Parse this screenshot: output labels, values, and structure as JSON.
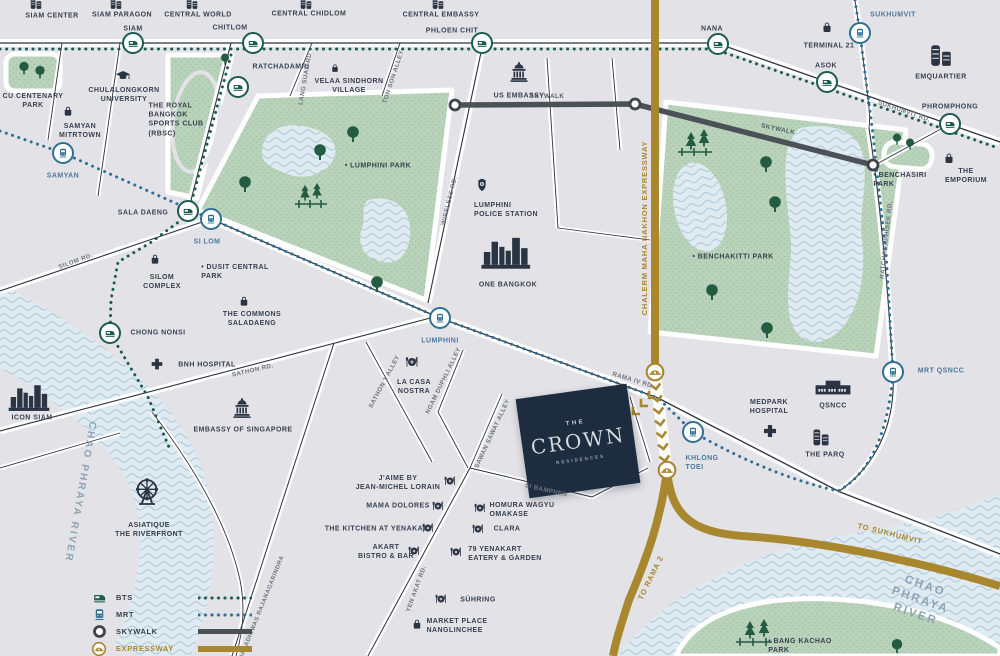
{
  "map": {
    "title": "The Crown Residences location map",
    "colors": {
      "bts": "#1c5b50",
      "mrt": "#2f7092",
      "skywalk": "#4b5157",
      "expressway": "#a8872e",
      "park": "#b9d2ba",
      "water": "#dfeaf1",
      "crown_navy": "#1d2d3f",
      "label_navy": "#39414e"
    },
    "crown": {
      "top": "THE",
      "name": "CROWN",
      "sub": "RESIDENCES"
    },
    "legend": {
      "items": [
        {
          "label": "BTS",
          "type": "bts"
        },
        {
          "label": "MRT",
          "type": "mrt"
        },
        {
          "label": "SKYWALK",
          "type": "skywalk"
        },
        {
          "label": "EXPRESSWAY",
          "type": "expressway"
        },
        {
          "label": "ROAD",
          "type": "road"
        }
      ]
    },
    "stations": [
      {
        "name": "station-siam",
        "type": "bts",
        "x": 133,
        "y": 43
      },
      {
        "name": "station-chitlom",
        "type": "bts",
        "x": 253,
        "y": 43
      },
      {
        "name": "station-phloen-chit",
        "type": "bts",
        "x": 482,
        "y": 43
      },
      {
        "name": "station-nana",
        "type": "bts",
        "x": 718,
        "y": 44
      },
      {
        "name": "station-asok",
        "type": "bts",
        "x": 827,
        "y": 82
      },
      {
        "name": "station-phromphong",
        "type": "bts",
        "x": 950,
        "y": 124
      },
      {
        "name": "station-ratchadamri",
        "type": "bts",
        "x": 238,
        "y": 87
      },
      {
        "name": "station-sala-daeng",
        "type": "bts",
        "x": 188,
        "y": 211
      },
      {
        "name": "station-chong-nonsi",
        "type": "bts",
        "x": 110,
        "y": 333
      },
      {
        "name": "station-sukhumvit",
        "type": "mrt",
        "x": 860,
        "y": 33
      },
      {
        "name": "station-samyan",
        "type": "mrt",
        "x": 63,
        "y": 153
      },
      {
        "name": "station-si-lom",
        "type": "mrt",
        "x": 211,
        "y": 219
      },
      {
        "name": "station-lumphini",
        "type": "mrt",
        "x": 440,
        "y": 318
      },
      {
        "name": "station-khlong-toei",
        "type": "mrt",
        "x": 693,
        "y": 432
      },
      {
        "name": "station-qsncc",
        "type": "mrt",
        "x": 893,
        "y": 372
      }
    ],
    "icons": [
      {
        "name": "siam-center-icon",
        "type": "towers",
        "x": 36,
        "y": 3,
        "s": 14
      },
      {
        "name": "siam-paragon-icon",
        "type": "towers",
        "x": 116,
        "y": 3,
        "s": 14
      },
      {
        "name": "central-world-icon",
        "type": "towers",
        "x": 192,
        "y": 3,
        "s": 14
      },
      {
        "name": "central-chidlom-icon",
        "type": "towers",
        "x": 306,
        "y": 3,
        "s": 14
      },
      {
        "name": "central-embassy-icon",
        "type": "towers",
        "x": 438,
        "y": 3,
        "s": 14
      },
      {
        "name": "terminal-21-icon",
        "type": "bag",
        "x": 827,
        "y": 27,
        "s": 14
      },
      {
        "name": "emquartier-icon",
        "type": "towers",
        "x": 941,
        "y": 55,
        "s": 26
      },
      {
        "name": "the-emporium-icon",
        "type": "bag",
        "x": 949,
        "y": 158,
        "s": 14
      },
      {
        "name": "velaa-sindhorn-icon",
        "type": "bag",
        "x": 335,
        "y": 68,
        "s": 11
      },
      {
        "name": "samyan-mitrtown-icon",
        "type": "bag",
        "x": 68,
        "y": 111,
        "s": 13
      },
      {
        "name": "silom-complex-icon",
        "type": "bag",
        "x": 155,
        "y": 259,
        "s": 13
      },
      {
        "name": "the-commons-icon",
        "type": "bag",
        "x": 244,
        "y": 301,
        "s": 13
      },
      {
        "name": "market-place-icon",
        "type": "bag",
        "x": 417,
        "y": 624,
        "s": 13
      },
      {
        "name": "us-embassy-icon",
        "type": "capitol",
        "x": 519,
        "y": 72,
        "s": 24
      },
      {
        "name": "embassy-singapore-icon",
        "type": "capitol",
        "x": 242,
        "y": 408,
        "s": 24
      },
      {
        "name": "chulalongkorn-icon",
        "type": "gradcap",
        "x": 123,
        "y": 76,
        "s": 17
      },
      {
        "name": "police-badge-icon",
        "type": "badge",
        "x": 482,
        "y": 185,
        "s": 16
      },
      {
        "name": "one-bangkok-icon",
        "type": "skyline",
        "x": 507,
        "y": 252,
        "w": 52,
        "h": 36
      },
      {
        "name": "icon-siam-icon",
        "type": "skyline",
        "x": 30,
        "y": 397,
        "w": 44,
        "h": 30
      },
      {
        "name": "qsncc-icon",
        "type": "hall",
        "x": 833,
        "y": 388,
        "w": 38,
        "h": 22
      },
      {
        "name": "the-parq-icon",
        "type": "towers",
        "x": 821,
        "y": 437,
        "s": 20
      },
      {
        "name": "bnh-cross-icon",
        "type": "cross",
        "x": 157,
        "y": 364,
        "s": 15
      },
      {
        "name": "medpark-cross-icon",
        "type": "cross",
        "x": 770,
        "y": 431,
        "s": 17
      },
      {
        "name": "asiatique-ferris-icon",
        "type": "ferris",
        "x": 147,
        "y": 492,
        "s": 32
      },
      {
        "name": "la-casa-nostra-icon",
        "type": "dining",
        "x": 412,
        "y": 362,
        "s": 16
      },
      {
        "name": "jaime-icon",
        "type": "dining",
        "x": 450,
        "y": 481,
        "s": 14
      },
      {
        "name": "mama-dolores-icon",
        "type": "dining",
        "x": 438,
        "y": 506,
        "s": 14
      },
      {
        "name": "kitchen-yenakat-icon",
        "type": "dining",
        "x": 428,
        "y": 528,
        "s": 14
      },
      {
        "name": "akart-icon",
        "type": "dining",
        "x": 414,
        "y": 551,
        "s": 14
      },
      {
        "name": "homura-icon",
        "type": "dining",
        "x": 480,
        "y": 508,
        "s": 14
      },
      {
        "name": "clara-icon",
        "type": "dining",
        "x": 478,
        "y": 529,
        "s": 14
      },
      {
        "name": "yenakart-79-icon",
        "type": "dining",
        "x": 456,
        "y": 552,
        "s": 14
      },
      {
        "name": "suhring-icon",
        "type": "dining",
        "x": 441,
        "y": 599,
        "s": 14
      },
      {
        "name": "interchange-icon",
        "type": "interchange",
        "x": 655,
        "y": 372,
        "s": 21
      },
      {
        "name": "interchange-icon",
        "type": "interchange",
        "x": 667,
        "y": 470,
        "s": 21
      },
      {
        "name": "skywalk-node-icon",
        "type": "ring",
        "x": 455,
        "y": 105,
        "s": 15
      },
      {
        "name": "skywalk-node-icon",
        "type": "ring",
        "x": 635,
        "y": 104,
        "s": 15
      },
      {
        "name": "skywalk-node-icon",
        "type": "ring",
        "x": 873,
        "y": 165,
        "s": 15
      }
    ],
    "labels": [
      {
        "name": "label-siam-center",
        "text": "SIAM CENTER",
        "x": 52,
        "y": 16
      },
      {
        "name": "label-siam-paragon",
        "text": "SIAM PARAGON",
        "x": 122,
        "y": 15
      },
      {
        "name": "label-central-world",
        "text": "CENTRAL WORLD",
        "x": 198,
        "y": 15
      },
      {
        "name": "label-central-chidlom",
        "text": "CENTRAL CHIDLOM",
        "x": 309,
        "y": 14
      },
      {
        "name": "label-central-embassy",
        "text": "CENTRAL EMBASSY",
        "x": 441,
        "y": 15
      },
      {
        "name": "label-st-siam",
        "text": "SIAM",
        "x": 133,
        "y": 29,
        "cls": "bts"
      },
      {
        "name": "label-st-chitlom",
        "text": "CHITLOM",
        "x": 230,
        "y": 28,
        "cls": "bts"
      },
      {
        "name": "label-st-phloen-chit",
        "text": "PHLOEN CHIT",
        "x": 452,
        "y": 31,
        "cls": "bts"
      },
      {
        "name": "label-st-ratchadamri",
        "text": "RATCHADAMRI",
        "x": 281,
        "y": 67,
        "cls": "bts"
      },
      {
        "name": "label-st-nana",
        "text": "NANA",
        "x": 712,
        "y": 29,
        "cls": "bts"
      },
      {
        "name": "label-st-asok",
        "text": "ASOK",
        "x": 826,
        "y": 66,
        "cls": "bts"
      },
      {
        "name": "label-st-phromphong",
        "text": "PHROMPHONG",
        "x": 950,
        "y": 107,
        "cls": "bts"
      },
      {
        "name": "label-st-sukhumvit",
        "text": "SUKHUMVIT",
        "x": 893,
        "y": 15,
        "cls": "mrt"
      },
      {
        "name": "label-terminal-21",
        "text": "TERMINAL 21",
        "x": 829,
        "y": 46
      },
      {
        "name": "label-emquartier",
        "text": "EMQUARTIER",
        "x": 941,
        "y": 77
      },
      {
        "name": "label-sukhumvit-rd",
        "text": "SUKHUMVIT RD.",
        "x": 904,
        "y": 112,
        "cls": "road",
        "rot": 19
      },
      {
        "name": "label-lang-suan-rd",
        "text": "LANG SUAN RD",
        "x": 306,
        "y": 79,
        "cls": "road",
        "rot": -80
      },
      {
        "name": "label-ton-son-alley",
        "text": "TON SON ALLEY",
        "x": 394,
        "y": 77,
        "cls": "road",
        "rot": -72
      },
      {
        "name": "label-velaa",
        "text": "VELAA SINDHORN\nVILLAGE",
        "x": 349,
        "y": 86
      },
      {
        "name": "label-cu-park",
        "text": "CU CENTENARY\nPARK",
        "x": 33,
        "y": 101
      },
      {
        "name": "label-chula",
        "text": "CHULALONGKORN\nUNIVERSITY",
        "x": 124,
        "y": 95
      },
      {
        "name": "label-samyan-mitrtown",
        "text": "SAMYAN\nMITRTOWN",
        "x": 80,
        "y": 131
      },
      {
        "name": "label-rbsc",
        "text": "THE ROYAL\nBANGKOK\nSPORTS CLUB\n(RBSC)",
        "x": 176,
        "y": 120,
        "align": "left"
      },
      {
        "name": "label-st-samyan",
        "text": "SAMYAN",
        "x": 63,
        "y": 176,
        "cls": "mrt"
      },
      {
        "name": "label-us-embassy",
        "text": "US EMBASSY",
        "x": 519,
        "y": 96
      },
      {
        "name": "label-skywalk-1",
        "text": "SKYWALK",
        "x": 547,
        "y": 97,
        "cls": "sky"
      },
      {
        "name": "label-skywalk-2",
        "text": "SKYWALK",
        "x": 778,
        "y": 130,
        "cls": "sky",
        "rot": 12
      },
      {
        "name": "label-lumphini-park",
        "text": "•  LUMPHINI PARK",
        "x": 378,
        "y": 166
      },
      {
        "name": "label-benchakitti-park",
        "text": "•  BENCHAKITTI PARK",
        "x": 733,
        "y": 257
      },
      {
        "name": "label-benchasiri-park",
        "text": "•  BENCHASIRI\n PARK",
        "x": 900,
        "y": 180,
        "align": "left"
      },
      {
        "name": "label-the-emporium",
        "text": "THE EMPORIUM",
        "x": 966,
        "y": 176
      },
      {
        "name": "label-ratchadaphisek-rd",
        "text": "RATCHADAPHISEK RD.",
        "x": 887,
        "y": 240,
        "cls": "road",
        "rot": -84
      },
      {
        "name": "label-mrt-qsncc",
        "text": "MRT QSNCC",
        "x": 941,
        "y": 371,
        "cls": "mrt"
      },
      {
        "name": "label-st-sala-daeng",
        "text": "SALA DAENG",
        "x": 143,
        "y": 213,
        "cls": "bts"
      },
      {
        "name": "label-st-si-lom",
        "text": "SI LOM",
        "x": 207,
        "y": 242,
        "cls": "mrt"
      },
      {
        "name": "label-silom-rd",
        "text": "SILOM RD.",
        "x": 76,
        "y": 262,
        "cls": "road",
        "rot": -20
      },
      {
        "name": "label-silom-complex",
        "text": "SILOM\nCOMPLEX",
        "x": 162,
        "y": 282
      },
      {
        "name": "label-dusit-central-park",
        "text": "•  DUSIT CENTRAL\n PARK",
        "x": 235,
        "y": 272,
        "align": "left"
      },
      {
        "name": "label-the-commons",
        "text": "THE COMMONS\nSALADAENG",
        "x": 252,
        "y": 319
      },
      {
        "name": "label-st-chong-nonsi",
        "text": "CHONG NONSI",
        "x": 158,
        "y": 333,
        "cls": "bts"
      },
      {
        "name": "label-bnh",
        "text": "BNH HOSPITAL",
        "x": 207,
        "y": 365
      },
      {
        "name": "label-sathon-rd",
        "text": "SATHON RD.",
        "x": 253,
        "y": 371,
        "cls": "road",
        "rot": -13
      },
      {
        "name": "label-police-station",
        "text": "LUMPHINI\nPOLICE STATION",
        "x": 506,
        "y": 210,
        "align": "left"
      },
      {
        "name": "label-one-bangkok",
        "text": "ONE BANGKOK",
        "x": 508,
        "y": 285
      },
      {
        "name": "label-wireless-rd",
        "text": "WIRELESS RD.",
        "x": 450,
        "y": 201,
        "cls": "road",
        "rot": -76
      },
      {
        "name": "label-expressway",
        "text": "CHALERM MAHA NAKHON   EXPRESSWAY",
        "x": 645,
        "y": 228,
        "cls": "gold",
        "rot": -90
      },
      {
        "name": "label-st-lumphini",
        "text": "LUMPHINI",
        "x": 440,
        "y": 341,
        "cls": "mrt"
      },
      {
        "name": "label-rama4-rd",
        "text": "RAMA IV RD.",
        "x": 633,
        "y": 381,
        "cls": "road",
        "rot": 17
      },
      {
        "name": "label-icon-siam",
        "text": "ICON SIAM",
        "x": 32,
        "y": 418
      },
      {
        "name": "label-embassy-singapore",
        "text": "EMBASSY OF SINGAPORE",
        "x": 243,
        "y": 430
      },
      {
        "name": "label-asiatique",
        "text": "ASIATIQUE\nTHE RIVERFRONT",
        "x": 149,
        "y": 530
      },
      {
        "name": "label-chao-phraya-left",
        "text": "CHAO PHRAYA RIVER",
        "x": 80,
        "y": 492,
        "cls": "river",
        "rot": 100
      },
      {
        "name": "label-sathon1-alley",
        "text": "SATHON 1 ALLEY",
        "x": 385,
        "y": 382,
        "cls": "road",
        "rot": -62
      },
      {
        "name": "label-ngam-duphli",
        "text": "NGAM DUPHLI ALLEY",
        "x": 444,
        "y": 381,
        "cls": "road",
        "rot": -64
      },
      {
        "name": "label-la-casa-nostra",
        "text": "LA CASA\nNOSTRA",
        "x": 414,
        "y": 387
      },
      {
        "name": "label-sawan-sawat",
        "text": "SAWAN SAWAT ALLEY",
        "x": 493,
        "y": 434,
        "cls": "road",
        "rot": -65
      },
      {
        "name": "label-si-bamphen",
        "text": "SI BAMPHEN",
        "x": 546,
        "y": 491,
        "cls": "road",
        "rot": 13
      },
      {
        "name": "label-jaime",
        "text": "J'AIME BY\nJEAN-MICHEL LORAIN",
        "x": 398,
        "y": 483
      },
      {
        "name": "label-mama-dolores",
        "text": "MAMA DOLORES",
        "x": 398,
        "y": 506
      },
      {
        "name": "label-kitchen-yenakat",
        "text": "THE KITCHEN AT YENAKAT",
        "x": 376,
        "y": 529
      },
      {
        "name": "label-akart",
        "text": "AKART\nBISTRO & BAR",
        "x": 386,
        "y": 552
      },
      {
        "name": "label-homura",
        "text": "HOMURA WAGYU\nOMAKASE",
        "x": 522,
        "y": 510,
        "align": "left"
      },
      {
        "name": "label-clara",
        "text": "CLARA",
        "x": 507,
        "y": 529,
        "align": "left"
      },
      {
        "name": "label-yenakart-79",
        "text": "79 YENAKART\nEATERY & GARDEN",
        "x": 505,
        "y": 554,
        "align": "left"
      },
      {
        "name": "label-suhring",
        "text": "SÜHRING",
        "x": 478,
        "y": 600,
        "align": "left"
      },
      {
        "name": "label-market-place",
        "text": "MARKET PLACE\nNANGLINCHEE",
        "x": 457,
        "y": 626,
        "align": "left"
      },
      {
        "name": "label-yen-akat-rd",
        "text": "YEN AKAT RD.",
        "x": 417,
        "y": 589,
        "cls": "road",
        "rot": -70
      },
      {
        "name": "label-naradhiwas",
        "text": "NARADHIWAS RAJANAGARINDRA",
        "x": 263,
        "y": 608,
        "cls": "road",
        "rot": -68,
        "size": 6
      },
      {
        "name": "label-medpark",
        "text": "MEDPARK\nHOSPITAL",
        "x": 769,
        "y": 407
      },
      {
        "name": "label-qsncc",
        "text": "QSNCC",
        "x": 833,
        "y": 406
      },
      {
        "name": "label-the-parq",
        "text": "THE PARQ",
        "x": 825,
        "y": 455
      },
      {
        "name": "label-st-khlong-toei",
        "text": "KHLONG\nTOEI",
        "x": 702,
        "y": 463,
        "cls": "mrt",
        "align": "left"
      },
      {
        "name": "label-to-sukhumvit",
        "text": "TO SUKHUMVIT",
        "x": 890,
        "y": 534,
        "cls": "gold",
        "rot": 14
      },
      {
        "name": "label-to-rama-2",
        "text": "TO RAMA 2",
        "x": 651,
        "y": 578,
        "cls": "gold",
        "rot": -64
      },
      {
        "name": "label-chao-phraya-right",
        "text": "CHAO PHRAYA RIVER",
        "x": 920,
        "y": 601,
        "cls": "river",
        "rot": 19,
        "size": 11.5
      },
      {
        "name": "label-bang-kachao",
        "text": "•  BANG KACHAO\n PARK",
        "x": 800,
        "y": 646,
        "align": "left"
      }
    ]
  }
}
